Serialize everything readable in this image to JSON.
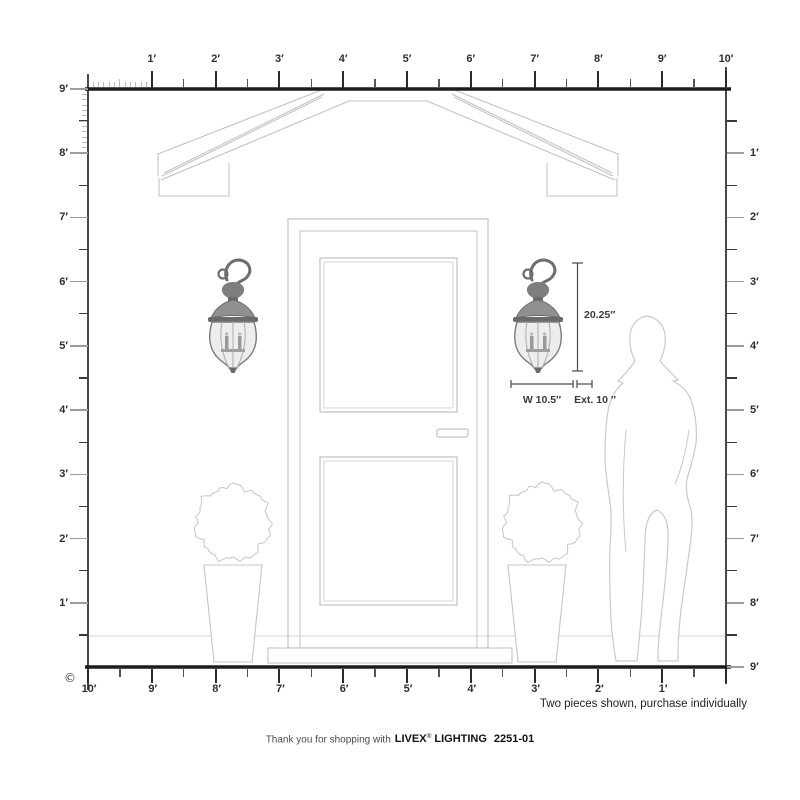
{
  "page": {
    "copyright_symbol": "©"
  },
  "rulers": {
    "top": [
      "1′",
      "2′",
      "3′",
      "4′",
      "5′",
      "6′",
      "7′",
      "8′",
      "9′",
      "10′"
    ],
    "left": [
      "9′",
      "8′",
      "7′",
      "6′",
      "5′",
      "4′",
      "3′",
      "2′",
      "1′"
    ],
    "right": [
      "1′",
      "2′",
      "3′",
      "4′",
      "5′",
      "6′",
      "7′",
      "8′",
      "9′"
    ],
    "bottom": [
      "10′",
      "9′",
      "8′",
      "7′",
      "6′",
      "5′",
      "4′",
      "3′",
      "2′",
      "1′"
    ]
  },
  "product": {
    "dim_height": "20.25″",
    "dim_width": "W 10.5″",
    "dim_extension": "Ext. 10 ″"
  },
  "footer": {
    "note": "Two pieces shown, purchase individually",
    "thanks": "Thank you for shopping with",
    "brand": "LIVEX",
    "registered_mark": "®",
    "brand2": "LIGHTING",
    "model": "2251-01"
  },
  "colors": {
    "drawing_line": "#c2c2c2",
    "ruler_line": "#1c1c1c",
    "label_text": "#2e2e2e",
    "metal_dark": "#6a6a6a",
    "metal_mid": "#8e8e8e",
    "glass": "#ededed"
  }
}
